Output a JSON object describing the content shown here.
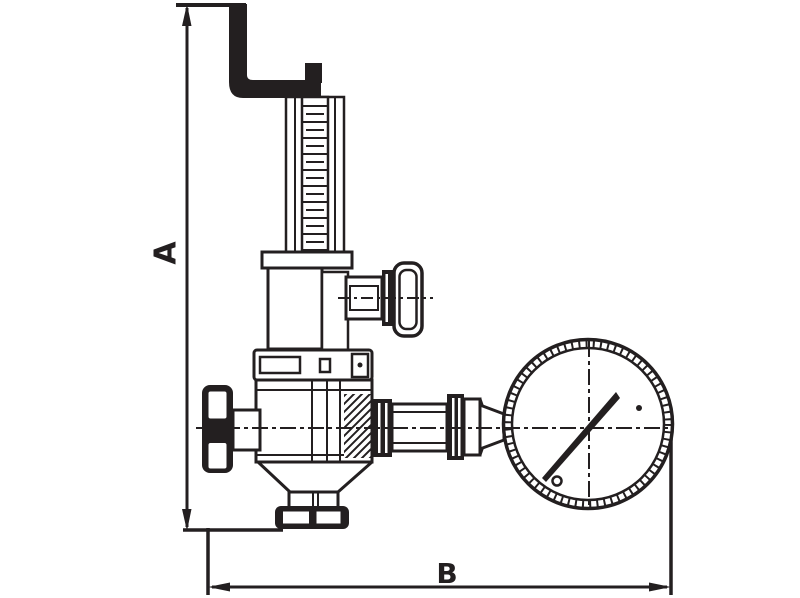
{
  "drawing": {
    "type": "technical-dimension-drawing",
    "dimension_a_label": "A",
    "dimension_b_label": "B"
  },
  "colors": {
    "line_color": "#231f20",
    "background": "#ffffff"
  }
}
